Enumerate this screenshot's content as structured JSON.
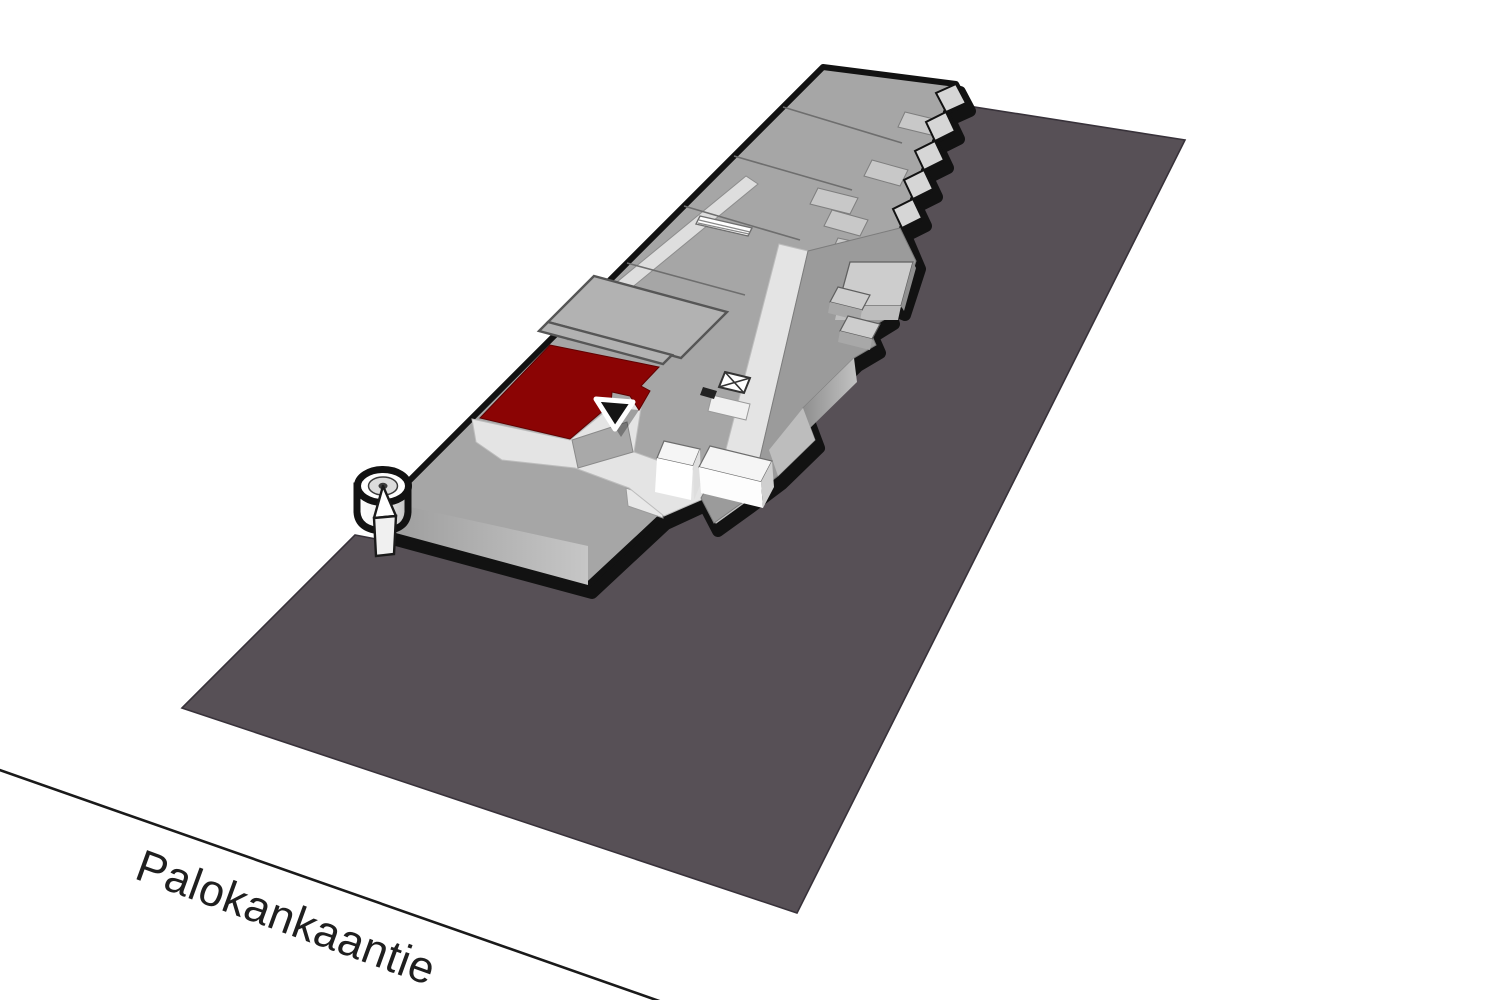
{
  "scene": {
    "type": "isometric-mall-map",
    "description": "3D axonometric site map of a single-storey shopping centre on a dark ground parcel, one unit highlighted in red with a location marker"
  },
  "street": {
    "name": "Palokankaantie"
  },
  "highlighted_unit": {
    "state": "selected",
    "color": "#8b0404"
  },
  "marker": {
    "shape": "downward-triangle",
    "fill": "#141414",
    "stroke": "#ffffff"
  },
  "colors": {
    "background": "#ffffff",
    "ground": "#575056",
    "groundStroke": "#38323a",
    "buildingBase": "#a6a6a6",
    "centerBlock": "#9b9b9b",
    "mallLight": "#e4e4e4",
    "serviceBand": "#dedede",
    "canopy": "#c8c8c8",
    "unitFill": "#b2b2b2",
    "red": "#8b0404",
    "outline": "#121212",
    "whiteBox": "#f6f6f6",
    "roadLine": "#1a1a1a",
    "labelColor": "#1f1f1f",
    "towerTop": "#ffffff",
    "towerInner": "#dcdcdc"
  }
}
